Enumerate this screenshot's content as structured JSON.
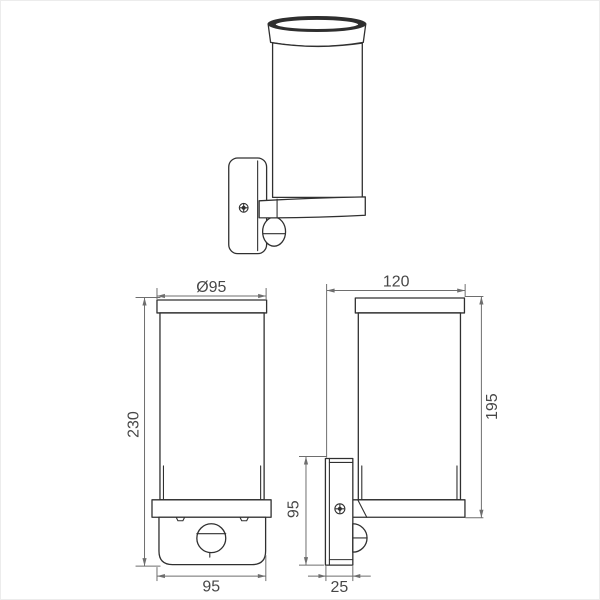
{
  "drawing": {
    "type": "technical dimension drawing",
    "subject": "wall-mounted cylindrical sensor wall light",
    "background_color": "#ffffff",
    "object_line_color": "#303030",
    "dimension_line_color": "#6e6e6e",
    "label_text_color": "#474747",
    "views": {
      "perspective": {
        "name": "perspective view of wall lamp with motion sensor"
      },
      "front": {
        "name": "front elevation",
        "dimensions": {
          "diameter": {
            "label": "Ø95",
            "orientation": "horizontal-top"
          },
          "overall_height": {
            "label": "230",
            "orientation": "vertical-left"
          },
          "base_width": {
            "label": "95",
            "orientation": "horizontal-bottom"
          }
        }
      },
      "side": {
        "name": "side elevation",
        "dimensions": {
          "depth": {
            "label": "120",
            "orientation": "horizontal-top"
          },
          "glass_height": {
            "label": "195",
            "orientation": "vertical-right"
          },
          "bracket_height": {
            "label": "95",
            "orientation": "vertical-left"
          },
          "bracket_depth": {
            "label": "25",
            "orientation": "horizontal-bottom"
          }
        }
      }
    }
  }
}
